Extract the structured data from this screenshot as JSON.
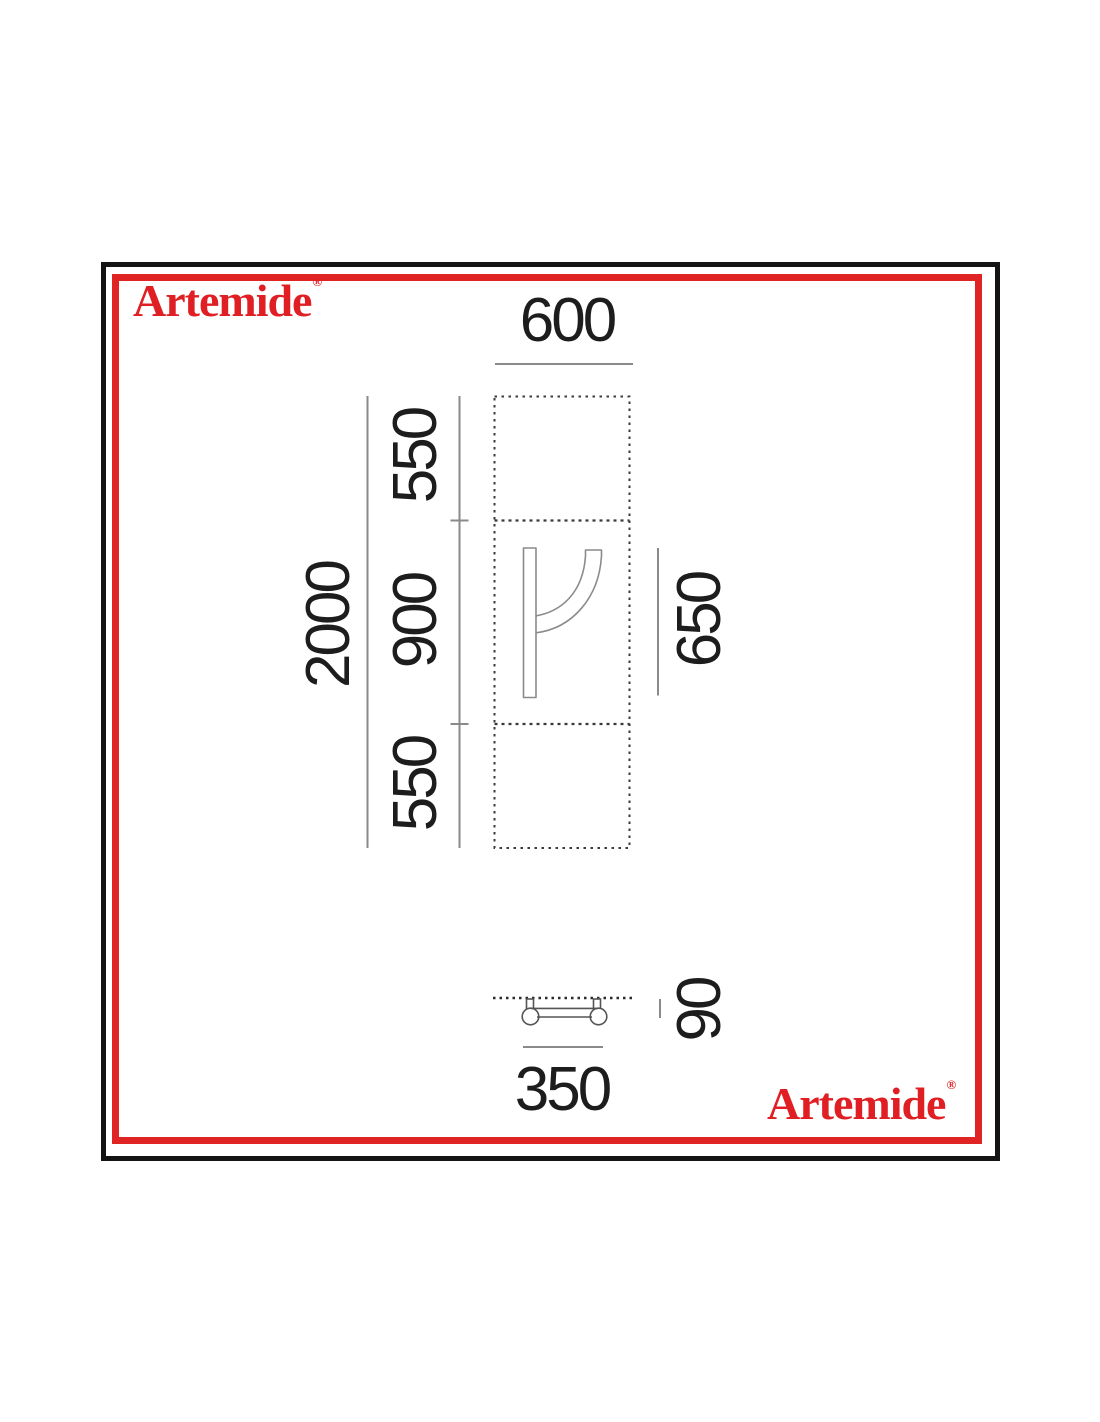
{
  "brand": {
    "name": "Artemide",
    "registered_mark": "®",
    "red": "#e01f24"
  },
  "frame": {
    "outer_border_color": "#141414",
    "inner_border_color": "#e02424"
  },
  "diagram": {
    "front_view": {
      "width": "600",
      "total_height": "2000",
      "top_segment": "550",
      "middle_segment": "900",
      "bottom_segment": "550",
      "body_height": "650"
    },
    "side_view": {
      "width": "350",
      "depth": "90"
    }
  }
}
